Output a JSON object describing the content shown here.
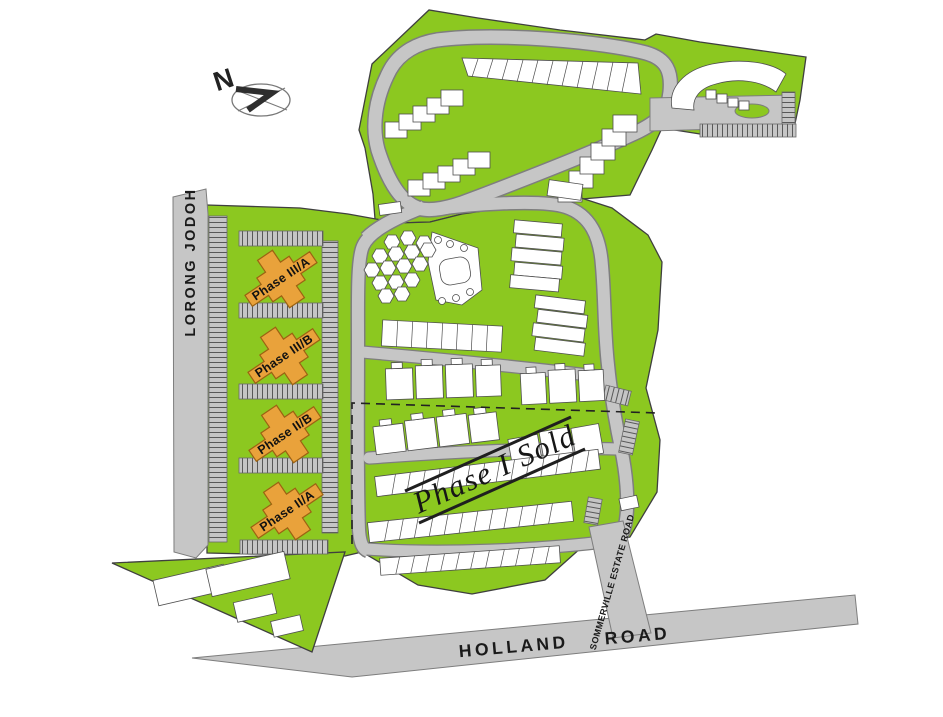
{
  "compass": {
    "label": "N"
  },
  "roads": {
    "lorong_jodoh": {
      "label": "LORONG JODOH"
    },
    "sommerville": {
      "label": "SOMMERVILLE ESTATE ROAD"
    },
    "holland": {
      "label": "HOLLAND ROAD"
    }
  },
  "phases": {
    "phase_3a": {
      "label": "Phase III/A"
    },
    "phase_3b": {
      "label": "Phase III/B"
    },
    "phase_2b": {
      "label": "Phase II/B"
    },
    "phase_2a": {
      "label": "Phase II/A"
    },
    "phase_1": {
      "label": "Phase I Sold"
    }
  },
  "colors": {
    "estate_green": "#8CC820",
    "road_gray": "#C6C6C6",
    "building_white": "#FFFFFF",
    "phase_orange": "#E9A23B",
    "label_black": "#1A1A1A"
  }
}
